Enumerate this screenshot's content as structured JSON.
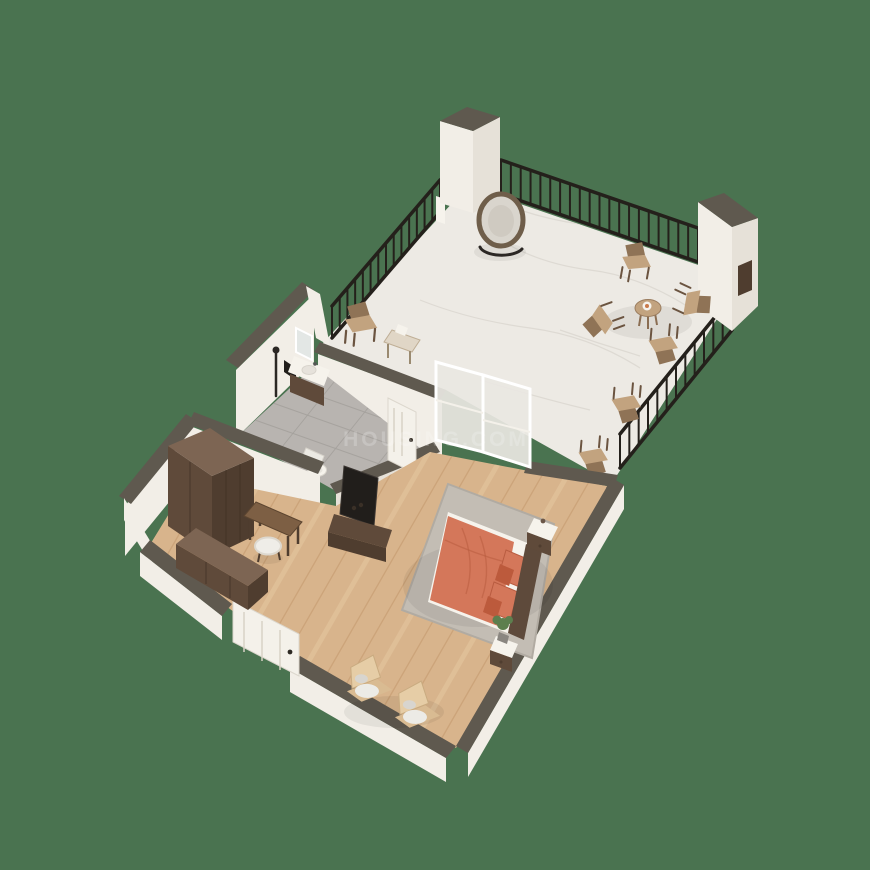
{
  "watermark": {
    "text": "HOUSING.COM"
  },
  "colors": {
    "background": "#4a7350",
    "wall_face": "#f2eee7",
    "wall_shade": "#e6e1d8",
    "wall_cap": "#5f594f",
    "railing": "#24201b",
    "marble": "#edeae4",
    "marble_vein": "#dbd7d0",
    "wood": "#d8b48c",
    "plank_dark": "#c09468",
    "plank_light": "#eacfa9",
    "tile": "#b8b4b0",
    "grout": "#a5a19d",
    "rug": "#c3bdb4",
    "rug_edge": "#b1aba2",
    "bed": "#d4775a",
    "bed_fold": "#b85c40",
    "pillow_dark": "#bc5a3c",
    "headboard": "#5e4a3b",
    "wood_dark": "#4f3d2f",
    "wood_mid": "#5f4a3a",
    "wood_top": "#7d6553",
    "chair_back": "#8f7356",
    "chair_seat": "#c2a37f",
    "chair_leg": "#6b5440",
    "cushion": "#ecebe6",
    "white_furn": "#f6f3ec",
    "door": "#f4f1ea",
    "glass": "#e9e7e2",
    "tv": "#211e1b",
    "plant": "#5d7f4e"
  },
  "scene": {
    "type": "3d-floor-plan",
    "view": "isometric-cutaway",
    "rooms": [
      {
        "name": "Terrace",
        "floor": "white marble",
        "features": [
          "black metal railing",
          "two white pillars",
          "round papasan chair",
          "coffee table with plate",
          "four wooden chairs",
          "two wooden chairs along railing",
          "wooden armchair by wall",
          "side table"
        ]
      },
      {
        "name": "Bedroom",
        "floor": "light wood planks",
        "features": [
          "double bed with coral bedding",
          "coral pillows",
          "grey area rug",
          "two white nightstands",
          "potted plant",
          "tv with low console",
          "two wooden lounge chairs with white cushions",
          "sliding glass door to terrace",
          "entrance door"
        ]
      },
      {
        "name": "Bathroom",
        "floor": "grey tile",
        "features": [
          "vanity sink with wooden cabinet",
          "mirror",
          "wall shower set",
          "toilet",
          "door to bedroom"
        ]
      },
      {
        "name": "Dressing Area",
        "floor": "light wood planks",
        "features": [
          "tall brown wardrobe",
          "long brown dresser",
          "wooden desk",
          "white fluffy stool"
        ]
      }
    ]
  }
}
